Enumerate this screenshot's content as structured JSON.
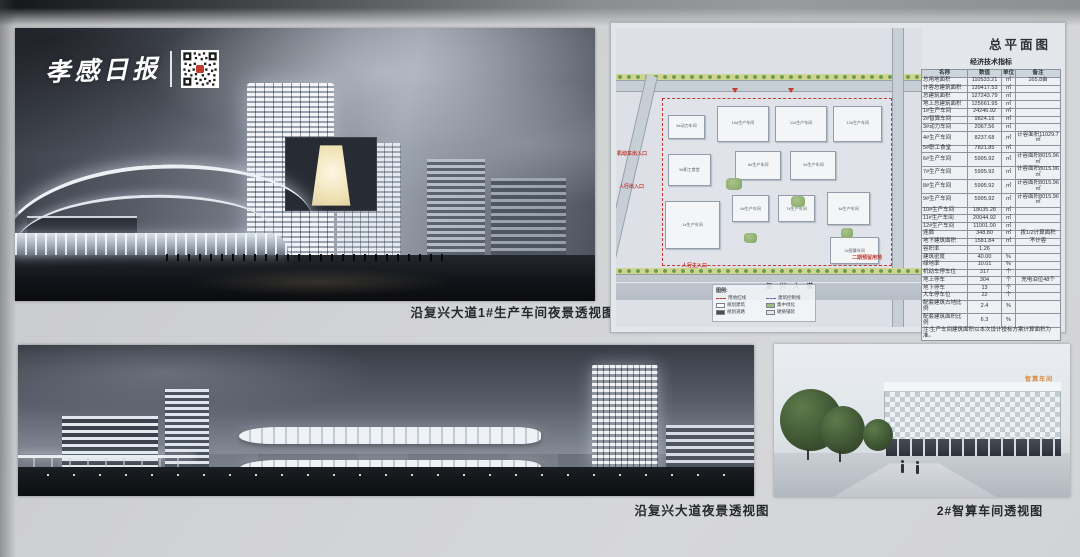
{
  "publication": {
    "name": "孝感日报"
  },
  "panel_render_main": {
    "caption": "沿复兴大道1#生产车间夜景透视图"
  },
  "panel_siteplan": {
    "title": "总平面图",
    "road_label": "复兴大道",
    "annotations": {
      "vehicle_entrance": "机动车出入口",
      "pedestrian_entrance": "人行出入口",
      "pedestrian_main_entrance": "人行主入口",
      "phase2_reserved": "二期预留用地"
    },
    "buildings": [
      {
        "label": "3#动力车间"
      },
      {
        "label": "10#生产车间"
      },
      {
        "label": "11#生产车间"
      },
      {
        "label": "12#生产车间"
      },
      {
        "label": "5#职工食堂"
      },
      {
        "label": "8#生产车间"
      },
      {
        "label": "9#生产车间"
      },
      {
        "label": "1#生产车间"
      },
      {
        "label": "6#生产车间"
      },
      {
        "label": "7#生产车间"
      },
      {
        "label": "4#生产车间"
      },
      {
        "label": "2#智算车间"
      }
    ],
    "legend": {
      "title": "图例:",
      "items": [
        {
          "label": "用地红线",
          "color": "#c23b2e",
          "style": "dashed-line"
        },
        {
          "label": "建筑控制线",
          "color": "#7a62a8",
          "style": "dashed-line"
        },
        {
          "label": "规划建筑",
          "color": "#ffffff",
          "style": "box"
        },
        {
          "label": "集中绿化",
          "color": "#9dbd7e",
          "style": "box"
        },
        {
          "label": "规划道路",
          "color": "#4a4f57",
          "style": "box"
        },
        {
          "label": "硬质铺装",
          "color": "#e3e6e9",
          "style": "box"
        }
      ]
    },
    "table": {
      "title": "经济技术指标",
      "columns": [
        "名称",
        "数值",
        "单位",
        "备注"
      ],
      "rows": [
        [
          "总用地面积",
          "110533.21",
          "㎡",
          "165.8亩"
        ],
        [
          "计容总建筑面积",
          "139417.53",
          "㎡",
          ""
        ],
        [
          "总建筑面积",
          "127243.79",
          "㎡",
          ""
        ],
        [
          "地上总建筑面积",
          "125661.95",
          "㎡",
          ""
        ],
        [
          "1#生产车间",
          "24246.92",
          "㎡",
          ""
        ],
        [
          "2#智算车间",
          "9824.16",
          "㎡",
          ""
        ],
        [
          "3#动力车间",
          "2067.56",
          "㎡",
          ""
        ],
        [
          "4#生产车间",
          "8237.68",
          "㎡",
          "计容面积11029.7㎡"
        ],
        [
          "5#职工食堂",
          "7821.85",
          "㎡",
          ""
        ],
        [
          "6#生产车间",
          "5995.92",
          "㎡",
          "计容面积8015.96㎡"
        ],
        [
          "7#生产车间",
          "5995.92",
          "㎡",
          "计容面积8015.96㎡"
        ],
        [
          "8#生产车间",
          "5995.92",
          "㎡",
          "计容面积8015.96㎡"
        ],
        [
          "9#生产车间",
          "5995.92",
          "㎡",
          "计容面积8015.96㎡"
        ],
        [
          "10#生产车间",
          "18035.28",
          "㎡",
          ""
        ],
        [
          "11#生产车间",
          "20044.92",
          "㎡",
          ""
        ],
        [
          "12#生产车间",
          "11001.00",
          "㎡",
          ""
        ],
        [
          "连廊",
          "348.80",
          "㎡",
          "按1/2计算面积"
        ],
        [
          "地下建筑面积",
          "1581.84",
          "㎡",
          "不计容"
        ],
        [
          "容积率",
          "1.26",
          "",
          ""
        ],
        [
          "建筑密度",
          "40.00",
          "%",
          ""
        ],
        [
          "绿地率",
          "10.01",
          "%",
          ""
        ],
        [
          "机动车停车位",
          "317",
          "个",
          ""
        ],
        [
          "地上停车",
          "304",
          "个",
          "充电泊位48个"
        ],
        [
          "地下停车",
          "13",
          "个",
          ""
        ],
        [
          "大车停车位",
          "22",
          "个",
          ""
        ],
        [
          "配套建筑占地比例",
          "2.4",
          "%",
          ""
        ],
        [
          "配套建筑面积比例",
          "6.3",
          "%",
          ""
        ]
      ],
      "footnote": "注:生产车间建筑面积以本次设计投标方案计算面积为准。"
    }
  },
  "panel_render_avenue": {
    "caption": "沿复兴大道夜景透视图"
  },
  "panel_render_workshop2": {
    "caption": "2#智算车间透视图",
    "building_sign": "智算车间"
  },
  "colors": {
    "annotation_red": "#c23b2e",
    "board_bg": "#cfd0d2",
    "caption_text": "#26292e"
  }
}
